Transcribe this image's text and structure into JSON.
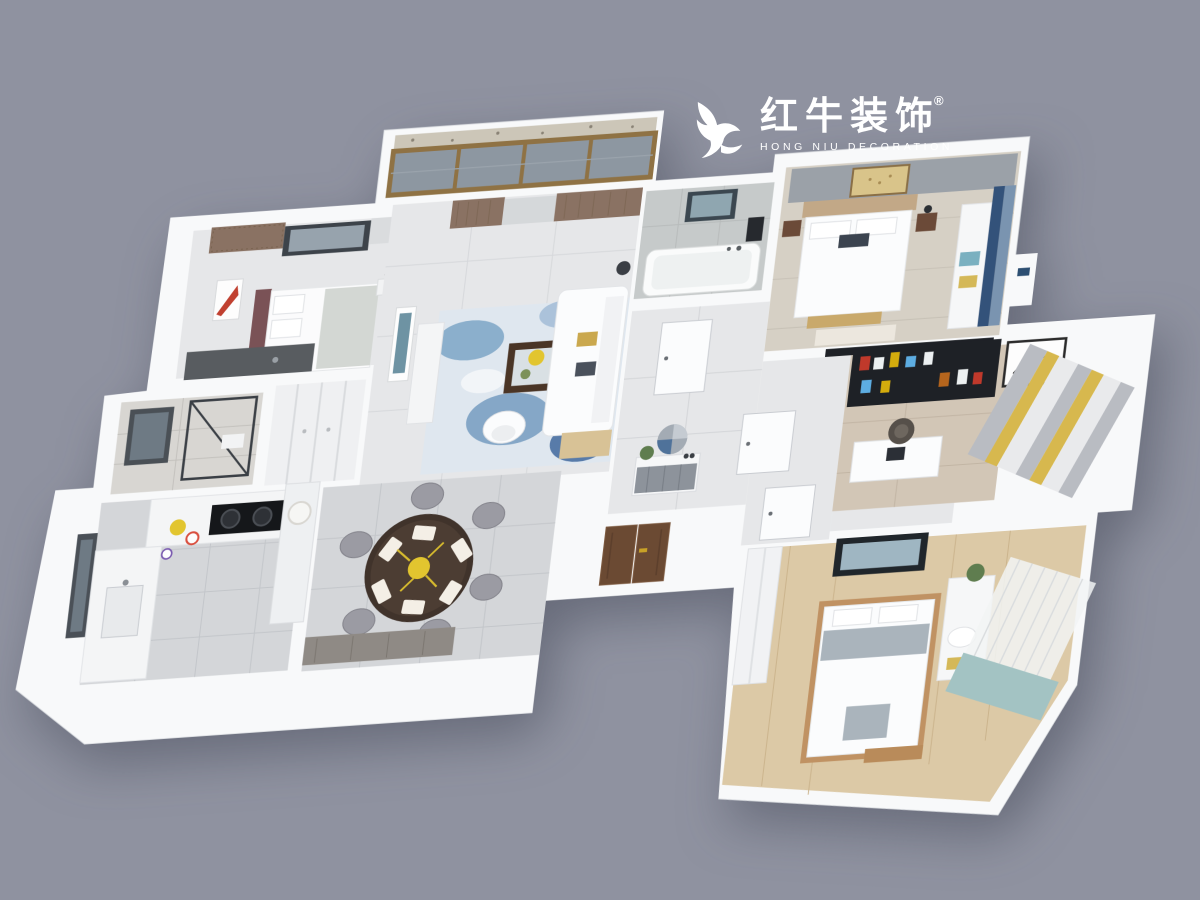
{
  "canvas": {
    "width": 1200,
    "height": 900,
    "background": "#8f92a0"
  },
  "logo": {
    "icon": "bull-swoosh",
    "registered_mark": "®",
    "title_cn": "红牛装饰",
    "subtitle_en": "HONG NIU DECORATION",
    "color": "#ffffff"
  },
  "palette": {
    "background": "#8f92a0",
    "wall": "#f8f9fa",
    "floor_tile": "#d4d6d9",
    "floor_light": "#e6e7e9",
    "floor_marble": "#c6caca",
    "floor_marble_light": "#d8d6d2",
    "floor_wood_gray": "#d6d0c5",
    "floor_wood_study": "#d2c6b6",
    "floor_wood_warm": "#dcc9a6",
    "rug_blue_base": "#dfe7ef",
    "curtain_brown": "#8a7263",
    "curtain_blue": "#33527a",
    "curtain_yellow": "#d7b84e",
    "entry_door_brown": "#6b4a33",
    "dark_fixture": "#1e2126",
    "accent_flower_yellow": "#e2c52f",
    "terrazzo": "#ccc6b8",
    "window_frame_wood": "#8f7244"
  },
  "rooms": [
    {
      "name": "north-bedroom"
    },
    {
      "name": "balcony"
    },
    {
      "name": "living-room"
    },
    {
      "name": "main-bathroom"
    },
    {
      "name": "master-bedroom"
    },
    {
      "name": "hallway"
    },
    {
      "name": "study"
    },
    {
      "name": "second-bathroom"
    },
    {
      "name": "hall-closet"
    },
    {
      "name": "kitchen"
    },
    {
      "name": "dining-room"
    },
    {
      "name": "entry"
    },
    {
      "name": "south-bedroom"
    }
  ]
}
